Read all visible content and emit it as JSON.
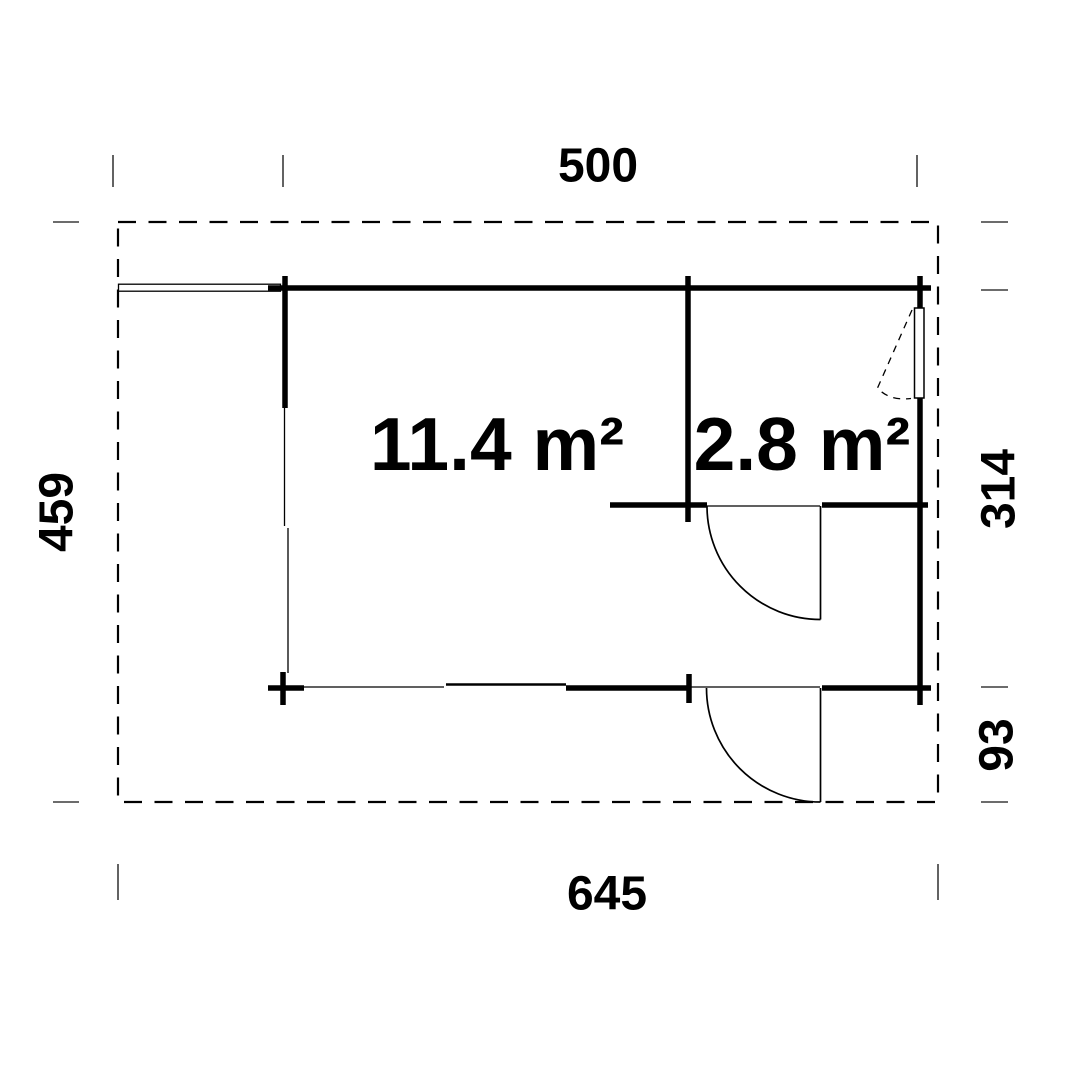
{
  "plan": {
    "title": "Floor plan",
    "rooms": [
      {
        "label": "11.4 m²"
      },
      {
        "label": "2.8 m²"
      }
    ],
    "dimensions": {
      "top": "500",
      "bottom": "645",
      "left": "459",
      "right_upper": "314",
      "right_lower": "93"
    },
    "colors": {
      "line": "#000000",
      "dimension_tick": "#3c3c3c",
      "background": "#ffffff"
    }
  }
}
